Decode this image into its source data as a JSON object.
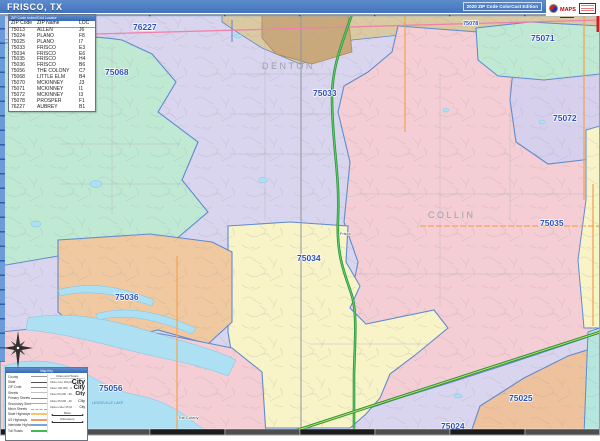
{
  "header": {
    "title": "FRISCO, TX",
    "edition": "2020 ZIP Code ColorCast Edition",
    "logo_text": "MAPS"
  },
  "zip_table": {
    "title": "ZIP Code Index/Grid Locator",
    "columns": {
      "code": "ZIP Code",
      "name": "ZIP Name",
      "loc": "LOC"
    },
    "rows": [
      {
        "code": "75013",
        "name": "ALLEN",
        "loc": "J6"
      },
      {
        "code": "75024",
        "name": "PLANO",
        "loc": "F8"
      },
      {
        "code": "75025",
        "name": "PLANO",
        "loc": "I7"
      },
      {
        "code": "75033",
        "name": "FRISCO",
        "loc": "E3"
      },
      {
        "code": "75034",
        "name": "FRISCO",
        "loc": "E6"
      },
      {
        "code": "75035",
        "name": "FRISCO",
        "loc": "H4"
      },
      {
        "code": "75036",
        "name": "FRISCO",
        "loc": "B6"
      },
      {
        "code": "75056",
        "name": "THE COLONY",
        "loc": "C7"
      },
      {
        "code": "75068",
        "name": "LITTLE ELM",
        "loc": "B4"
      },
      {
        "code": "75070",
        "name": "MCKINNEY",
        "loc": "J3"
      },
      {
        "code": "75071",
        "name": "MCKINNEY",
        "loc": "I1"
      },
      {
        "code": "75072",
        "name": "MCKINNEY",
        "loc": "I3"
      },
      {
        "code": "75078",
        "name": "PROSPER",
        "loc": "F1"
      },
      {
        "code": "76227",
        "name": "AUBREY",
        "loc": "B1"
      }
    ]
  },
  "map": {
    "colors": {
      "lavender": "#dad5ee",
      "lavender2": "#d6d0ec",
      "mint": "#c0e9d4",
      "pink": "#f4ced4",
      "yellow": "#f8f4c8",
      "peach": "#f0c9a0",
      "orange": "#eec29c",
      "tan": "#dbc9a2",
      "tan_dark": "#c9a97c",
      "teal": "#b6e7de",
      "lake": "#ade0f3"
    },
    "zip_labels": {
      "z76227": "76227",
      "z75068": "75068",
      "z75033": "75033",
      "z75078": "75078",
      "z75071": "75071",
      "z75072": "75072",
      "z75035": "75035",
      "z75034": "75034",
      "z75036": "75036",
      "z75056": "75056",
      "z75025": "75025",
      "z75024": "75024"
    },
    "county_labels": {
      "denton": "DENTON",
      "collin": "COLLIN"
    },
    "town_labels": {
      "frisco": "Frisco",
      "the_colony": "The Colony"
    },
    "water_label": "LEWISVILLE LAKE"
  },
  "legend": {
    "title": "Map Key",
    "line_items": [
      {
        "label": "County"
      },
      {
        "label": "State"
      },
      {
        "label": "ZIP Code"
      },
      {
        "label": "Streets"
      },
      {
        "label": "Primary Streets"
      },
      {
        "label": "Secondary Streets"
      },
      {
        "label": "Minor Streets"
      },
      {
        "label": "State Highways"
      },
      {
        "label": "US Highways"
      },
      {
        "label": "Interstate Highways"
      },
      {
        "label": "Toll Roads"
      }
    ],
    "cities_header": "Cities and Towns",
    "city_items": [
      {
        "label": "Cities over 250,000",
        "sample": "City"
      },
      {
        "label": "Cities 100,000 - 249,999",
        "sample": "City"
      },
      {
        "label": "Cities 50,000 - 99,999",
        "sample": "City"
      },
      {
        "label": "Cities 25,000 - 49,999",
        "sample": "City"
      },
      {
        "label": "Cities under 25,000",
        "sample": "City"
      }
    ],
    "scale": {
      "miles": "Miles",
      "kilometers": "Kilometers"
    }
  }
}
